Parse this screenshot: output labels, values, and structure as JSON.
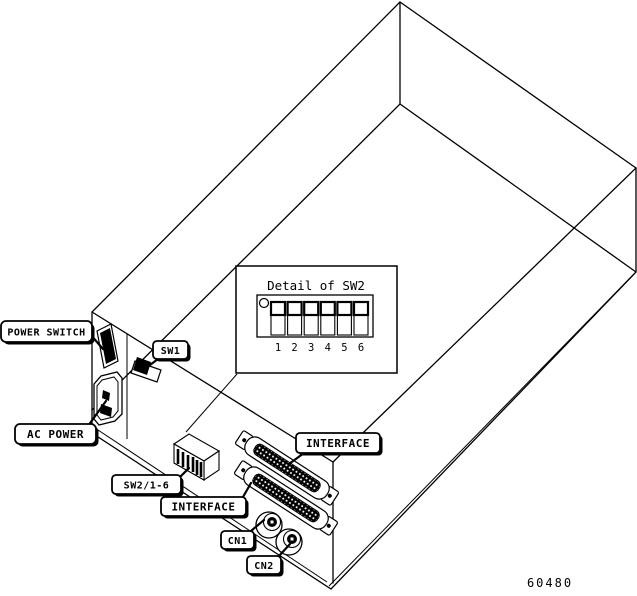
{
  "colors": {
    "line": "#000000",
    "background": "#ffffff"
  },
  "callouts": {
    "power_switch": "POWER SWITCH",
    "sw1": "SW1",
    "ac_power": "AC POWER",
    "sw2_1_6": "SW2/1-6",
    "interface_top": "INTERFACE",
    "interface_bottom": "INTERFACE",
    "cn1": "CN1",
    "cn2": "CN2"
  },
  "detail_panel": {
    "title": "Detail of SW2",
    "switch_count": 6,
    "switch_numbers": [
      "1",
      "2",
      "3",
      "4",
      "5",
      "6"
    ]
  },
  "figure_number": "60480"
}
